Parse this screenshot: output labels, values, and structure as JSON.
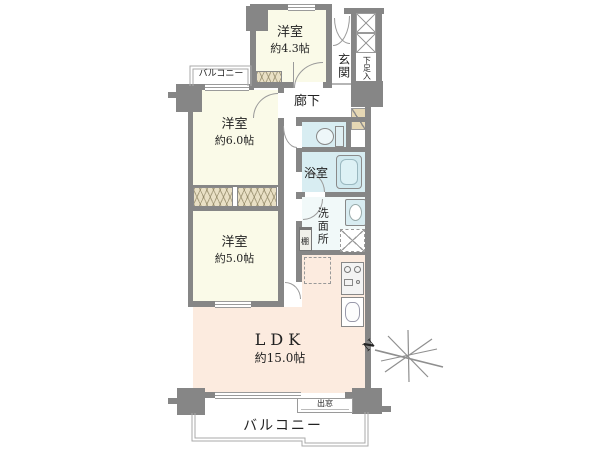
{
  "rooms": {
    "w43": {
      "label": "洋室",
      "size": "約4.3帖"
    },
    "w60": {
      "label": "洋室",
      "size": "約6.0帖"
    },
    "w50": {
      "label": "洋室",
      "size": "約5.0帖"
    },
    "ldk": {
      "label": "LDK",
      "size": "約15.0帖"
    },
    "entrance": {
      "label": "玄関"
    },
    "shoe_storage": {
      "label": "下足入"
    },
    "hallway": {
      "label": "廊下"
    },
    "bathroom": {
      "label": "浴室"
    },
    "washroom": {
      "label": "洗面所"
    },
    "shelf": {
      "label": "棚"
    },
    "balcony_top": {
      "label": "バルコニー"
    },
    "balcony_bottom": {
      "label": "バルコニー"
    },
    "bay_window": {
      "label": "出窓"
    }
  },
  "compass": {
    "north": "N"
  },
  "fixtures": [
    "toilet-icon",
    "bathtub-icon",
    "washbasin-icon",
    "washing-machine-space",
    "refrigerator-space",
    "kitchen-stove-icon",
    "kitchen-sink-icon",
    "shoe-cupboard-x-marks",
    "closet-hatch",
    "compass-rose-icon"
  ],
  "colors": {
    "wall": "#868686",
    "room_cream": "#fafae8",
    "ldk_peach": "#fcebdf",
    "wet_blue": "#d8edf2",
    "washroom_tint": "#f1f9f9",
    "closet_tan": "#e9e0c5",
    "corner_tan": "#e5d7b4",
    "outline": "#a9a9a9"
  }
}
